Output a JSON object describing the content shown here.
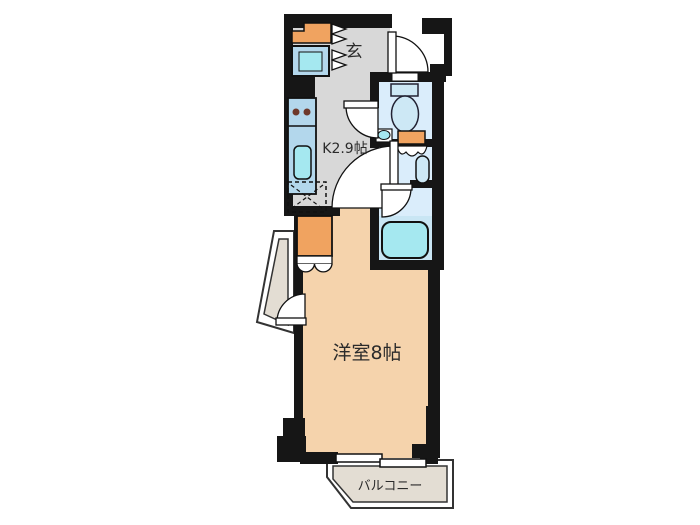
{
  "plan": {
    "title": "apartment-floor-plan",
    "labels": {
      "entrance": "玄",
      "kitchen": "K2.9帖",
      "main_room": "洋室8帖",
      "balcony": "バルコニー"
    },
    "colors": {
      "wall": "#161616",
      "hall_floor": "#d8d8d8",
      "room_floor": "#f5d3ac",
      "wet_floor": "#daedfb",
      "wet_floor_dark": "#c9e6f4",
      "fixture_blue": "#b3d7ec",
      "fixture_cyan": "#a5e8f0",
      "fixture_light_blue": "#cde8f5",
      "accent_orange": "#f0a360",
      "balcony_floor": "#e3ddd3",
      "burner": "#6e392b",
      "outline": "#111111",
      "text": "#2b2b2b",
      "white": "#ffffff"
    },
    "fixtures": [
      "entrance-door",
      "shoe-cabinet",
      "storage-box",
      "accordion-door",
      "kitchen-counter",
      "stove",
      "sink",
      "washer-space",
      "closet",
      "bifold-door",
      "toilet",
      "wash-basin",
      "vanity-cabinet",
      "water-heater",
      "bathtub",
      "sliding-window",
      "side-alcove",
      "balcony"
    ]
  }
}
